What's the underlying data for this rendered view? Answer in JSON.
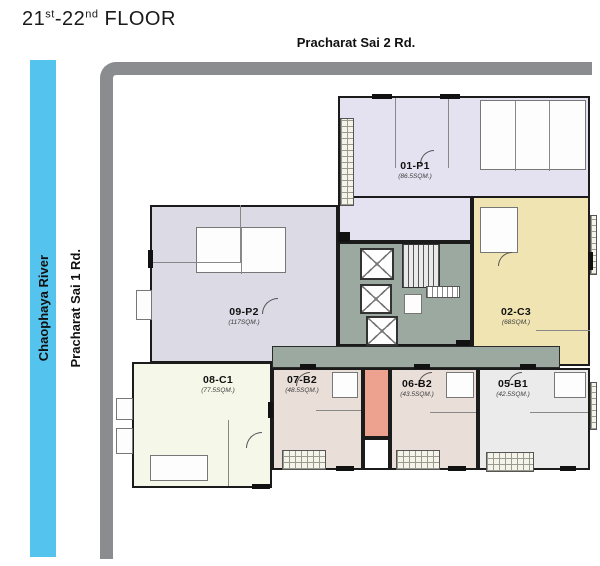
{
  "floor_title": {
    "start": "21",
    "sup_start": "st",
    "mid": "-22",
    "sup_mid": "nd",
    "suffix": "FLOOR"
  },
  "roads": {
    "top_label": "Pracharat Sai 2 Rd.",
    "left_label": "Pracharat Sai 1 Rd.",
    "color": "#8A8C90"
  },
  "river": {
    "label": "Chaophaya River",
    "color": "#54C3EE"
  },
  "units": [
    {
      "name": "01-P1",
      "area": "(86.5SQM.)",
      "color": "#E4E2F0"
    },
    {
      "name": "02-C3",
      "area": "(68SQM.)",
      "color": "#F0E5B2"
    },
    {
      "name": "09-P2",
      "area": "(117SQM.)",
      "color": "#DBDAE5"
    },
    {
      "name": "08-C1",
      "area": "(77.5SQM.)",
      "color": "#F5F7E8"
    },
    {
      "name": "07-B2",
      "area": "(48.5SQM.)",
      "color": "#E9DED8"
    },
    {
      "name": "06-B2",
      "area": "(43.5SQM.)",
      "color": "#E9DED8"
    },
    {
      "name": "05-B1",
      "area": "(42.5SQM.)",
      "color": "#EBEBEB"
    }
  ],
  "palette": {
    "wall": "#1B1B1B",
    "core": "#9BA9A1",
    "stair_well": "#ECA28F",
    "road": "#8A8C90",
    "river": "#54C3EE"
  }
}
